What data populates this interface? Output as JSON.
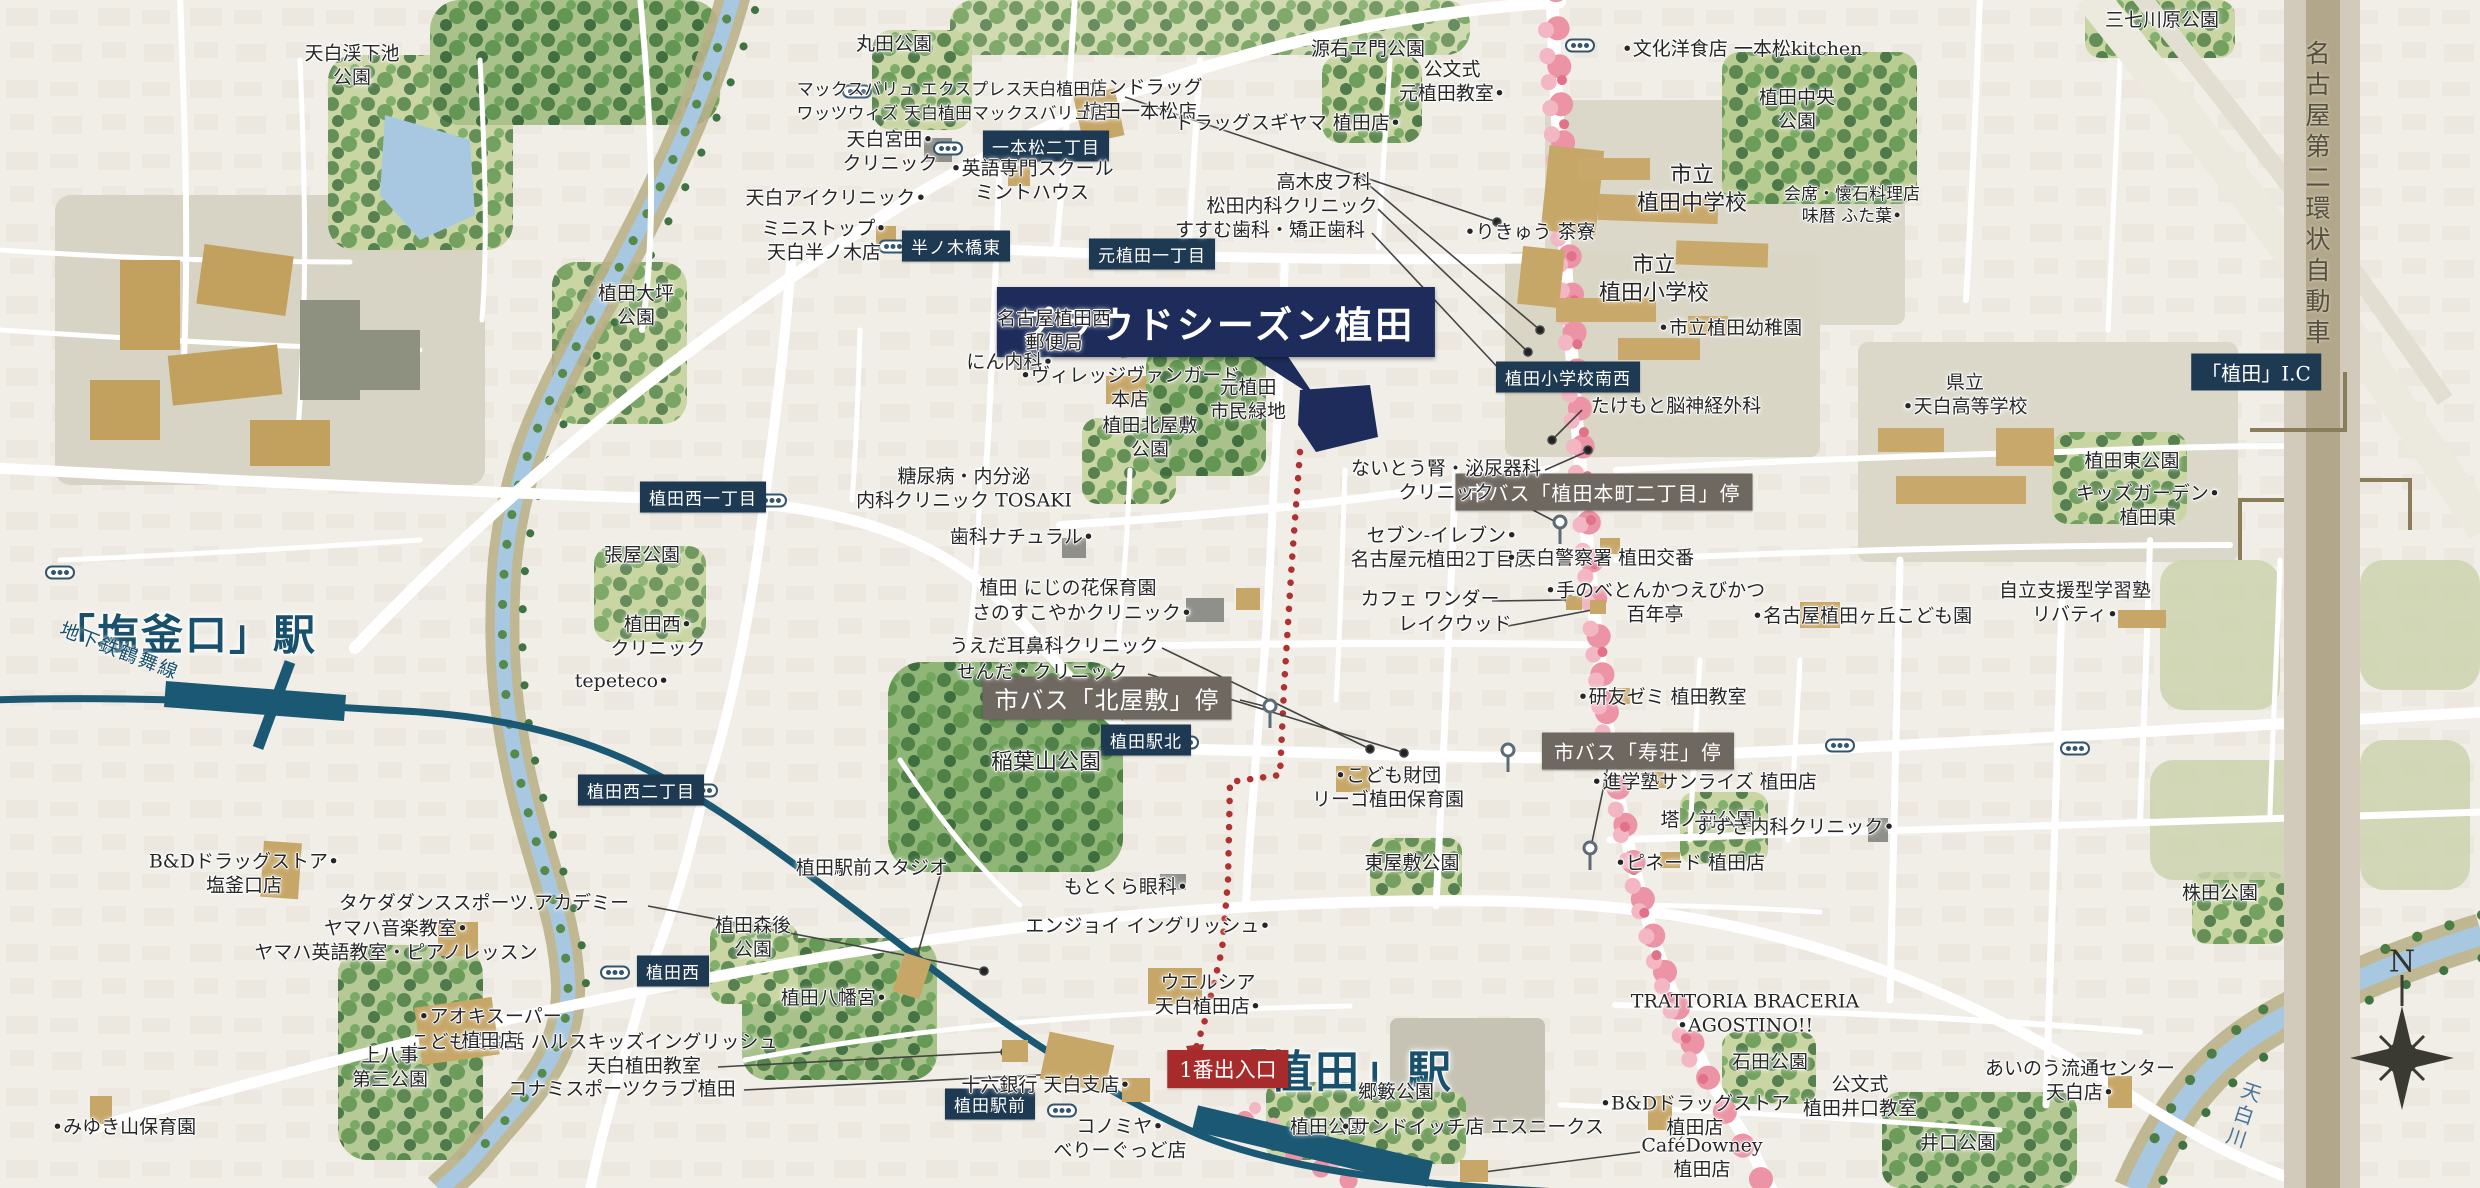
{
  "title": {
    "text": "プラウドシーズン植田"
  },
  "stations": {
    "shiogamaguchi": "「塩釜口」駅",
    "ueda": "「植田」駅",
    "ueda_ic": "「植田」I.C",
    "entrance_no1": "1番出入口"
  },
  "geo": {
    "subway_line": "地下鉄鶴舞線",
    "highway": "名古屋第二環状自動車",
    "river": "天白川",
    "compass_n": "N"
  },
  "intersections": [
    {
      "label": "一本松二丁目"
    },
    {
      "label": "半ノ木橋東"
    },
    {
      "label": "元植田一丁目"
    },
    {
      "label": "植田西一丁目"
    },
    {
      "label": "植田西二丁目"
    },
    {
      "label": "植田西"
    },
    {
      "label": "植田駅前"
    },
    {
      "label": "植田駅北"
    },
    {
      "label": "植田小学校南西"
    }
  ],
  "bus_stops": [
    {
      "label": "市バス「植田本町二丁目」停"
    },
    {
      "label": "市バス「北屋敷」停"
    },
    {
      "label": "市バス「寿荘」停"
    }
  ],
  "pois": [
    {
      "text": "丸田公園"
    },
    {
      "text": "天白渓下池\n公園"
    },
    {
      "text": "•サンドラッグ\n植田一本松店"
    },
    {
      "text": "源右ヱ門公園"
    },
    {
      "text": "公文式\n元植田教室•"
    },
    {
      "text": "•文化洋食店 一本松kitchen"
    },
    {
      "text": "植田中央\n公園"
    },
    {
      "text": "三七川原公園"
    },
    {
      "text": "天白宮田•\nクリニック"
    },
    {
      "text": "ドラッグスギヤマ 植田店•"
    },
    {
      "text": "マックスバリュ エクスプレス天白植田店"
    },
    {
      "text": "ワッツウィズ 天白植田マックスバリュ店"
    },
    {
      "text": "•英語専門スクール\nミントハウス"
    },
    {
      "text": "高木皮フ科"
    },
    {
      "text": "松田内科クリニック"
    },
    {
      "text": "すすむ歯科・矯正歯科"
    },
    {
      "text": "天白アイクリニック•"
    },
    {
      "text": "ミニストップ•\n天白半ノ木店"
    },
    {
      "text": "•りきゅう 茶寮"
    },
    {
      "text": "市立\n植田中学校"
    },
    {
      "text": "会席・懐石料理店\n味暦 ふた葉•"
    },
    {
      "text": "市立\n植田小学校"
    },
    {
      "text": "県立\n•天白高等学校"
    },
    {
      "text": "•市立植田幼稚園"
    },
    {
      "text": "植田大坪\n公園"
    },
    {
      "text": "名古屋植田西\n郵便局"
    },
    {
      "text": "にん内科•"
    },
    {
      "text": "•ヴィレッジヴァンガード\n本店"
    },
    {
      "text": "たけもと脳神経外科"
    },
    {
      "text": "元植田\n市民緑地"
    },
    {
      "text": "植田北屋敷\n公園"
    },
    {
      "text": "糖尿病・内分泌\n内科クリニック TOSAKI"
    },
    {
      "text": "ないとう腎・泌尿器科\nクリニック"
    },
    {
      "text": "植田東公園"
    },
    {
      "text": "キッズガーデン•\n植田東"
    },
    {
      "text": "歯科ナチュラル•"
    },
    {
      "text": "セブン-イレブン•\n名古屋元植田2丁目店"
    },
    {
      "text": "•天白警察署 植田交番"
    },
    {
      "text": "植田 にじの花保育園"
    },
    {
      "text": "さのすこやかクリニック•"
    },
    {
      "text": "カフェ ワンダー"
    },
    {
      "text": "レイクウッド"
    },
    {
      "text": "•手のべとんかつえびかつ\n百年亭"
    },
    {
      "text": "自立支援型学習塾\nリバティ•"
    },
    {
      "text": "•名古屋植田ヶ丘こども園"
    },
    {
      "text": "うえだ耳鼻科クリニック"
    },
    {
      "text": "せんだ・クリニック"
    },
    {
      "text": "•研友ゼミ 植田教室"
    },
    {
      "text": "稲葉山公園"
    },
    {
      "text": "•こども財団\nリーゴ植田保育園"
    },
    {
      "text": "•進学塾サンライズ 植田店"
    },
    {
      "text": "塔ノ前公園"
    },
    {
      "text": "すずき内科クリニック•"
    },
    {
      "text": "張屋公園"
    },
    {
      "text": "植田西•\nクリニック"
    },
    {
      "text": "tepeteco•"
    },
    {
      "text": "B&Dドラッグストア•\n塩釜口店"
    },
    {
      "text": "タケダダンススポーツ.アカデミー"
    },
    {
      "text": "植田駅前スタジオ"
    },
    {
      "text": "ヤマハ音楽教室•\nヤマハ英語教室・ピアノレッスン"
    },
    {
      "text": "植田森後\n公園"
    },
    {
      "text": "植田八幡宮•"
    },
    {
      "text": "もとくら眼科•"
    },
    {
      "text": "エンジョイ イングリッシュ•"
    },
    {
      "text": "東屋敷公園"
    },
    {
      "text": "ウエルシア\n天白植田店•"
    },
    {
      "text": "•ピネード 植田店"
    },
    {
      "text": "TRATTORIA BRACERIA\n•AGOSTINO!!"
    },
    {
      "text": "こども英会話 ハルスキッズイングリッシュ"
    },
    {
      "text": "天白植田教室"
    },
    {
      "text": "コナミスポーツクラブ植田"
    },
    {
      "text": "•アオキスーパー\n植田店"
    },
    {
      "text": "•みゆき山保育園"
    },
    {
      "text": "上八事\n第三公園"
    },
    {
      "text": "十六銀行 天白支店•"
    },
    {
      "text": "郷籔公園"
    },
    {
      "text": "コノミヤ•\nべりーぐっど店"
    },
    {
      "text": "植田公園"
    },
    {
      "text": "•サンドイッチ店 エスニークス"
    },
    {
      "text": "CaféDowney\n植田店"
    },
    {
      "text": "•B&Dドラッグストア\n植田店"
    },
    {
      "text": "石田公園"
    },
    {
      "text": "公文式\n植田井口教室"
    },
    {
      "text": "あいのう流通センター\n天白店•"
    },
    {
      "text": "井口公園"
    },
    {
      "text": "株田公園"
    }
  ]
}
